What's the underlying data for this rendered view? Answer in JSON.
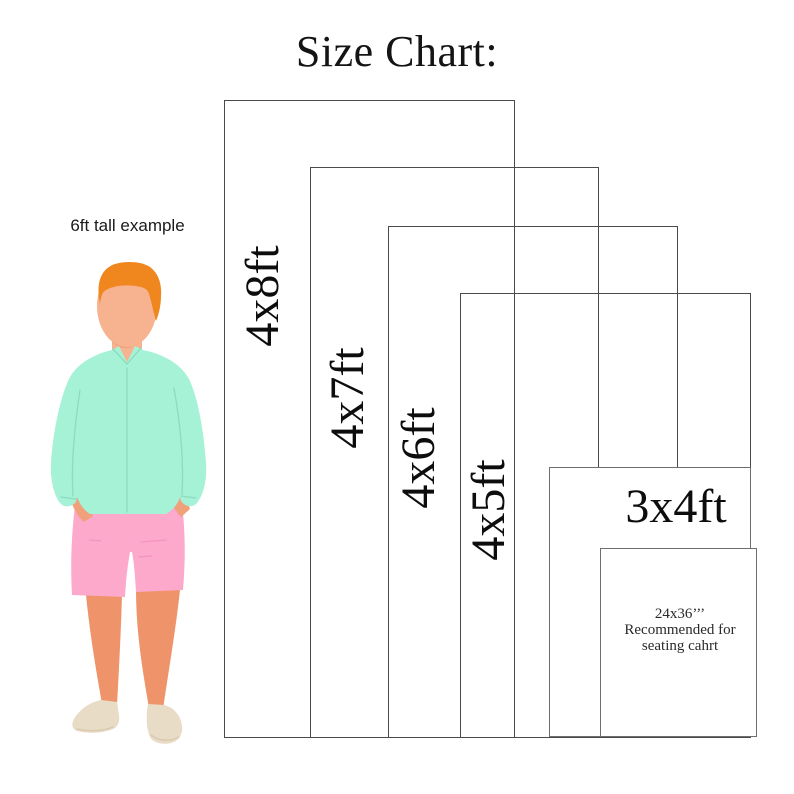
{
  "title": "Size Chart:",
  "person": {
    "caption": "6ft tall example"
  },
  "sizes": [
    {
      "label": "4x8ft"
    },
    {
      "label": "4x7ft"
    },
    {
      "label": "4x6ft"
    },
    {
      "label": "4x5ft"
    },
    {
      "label": "3x4ft"
    }
  ],
  "note": {
    "line1": "24x36’’’",
    "line2": "Recommended for",
    "line3": "seating cahrt"
  },
  "colors": {
    "outline": "#4a4a4a",
    "outline-light": "#6e6e6e",
    "hair": "#f0861e",
    "skin": "#f7b28f",
    "skin-shadow": "#e59a74",
    "skin-dark": "#ef946a",
    "skin-hand": "#f0a07a",
    "shirt": "#a5f2d6",
    "shirt-line": "#8bdcc0",
    "shorts": "#fca9cc",
    "shorts-line": "#f493bd",
    "shoes": "#e9dcc6",
    "shoes-line": "#d9c9b0"
  }
}
